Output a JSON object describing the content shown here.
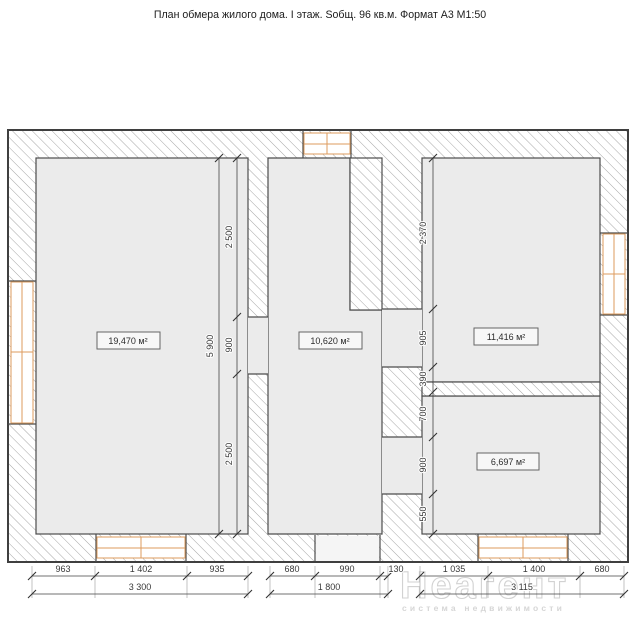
{
  "title": "План обмера жилого дома. I этаж. Sобщ. 96 кв.м. Формат А3  М1:50",
  "rooms": {
    "left": {
      "area": "19,470 м²"
    },
    "middle": {
      "area": "10,620 м²"
    },
    "right_top": {
      "area": "11,416 м²"
    },
    "right_bottom": {
      "area": "6,697 м²"
    }
  },
  "dimensions": {
    "bottom_left": {
      "segments": [
        "963",
        "1 402",
        "935"
      ],
      "total": "3 300"
    },
    "bottom_middle": {
      "segments": [
        "680",
        "990",
        "130"
      ],
      "total": "1 800"
    },
    "bottom_right": {
      "segments": [
        "1 035",
        "1 400",
        "680"
      ],
      "total": "3 115"
    },
    "vertical_left": {
      "segments": [
        "2 500",
        "900",
        "2 500"
      ],
      "total": "5 900"
    },
    "vertical_right": {
      "segments": [
        "2 370",
        "905",
        "390",
        "700",
        "900",
        "550"
      ]
    }
  },
  "watermark": {
    "brand": "Неагент",
    "tagline": "система недвижимости"
  },
  "colors": {
    "room_fill": "#ebebeb",
    "wall_stroke": "#3f3f3f",
    "hatch_line": "#a6a6a6",
    "window_frame": "#dd9b5d",
    "dimension_text": "#3a3a3a"
  }
}
